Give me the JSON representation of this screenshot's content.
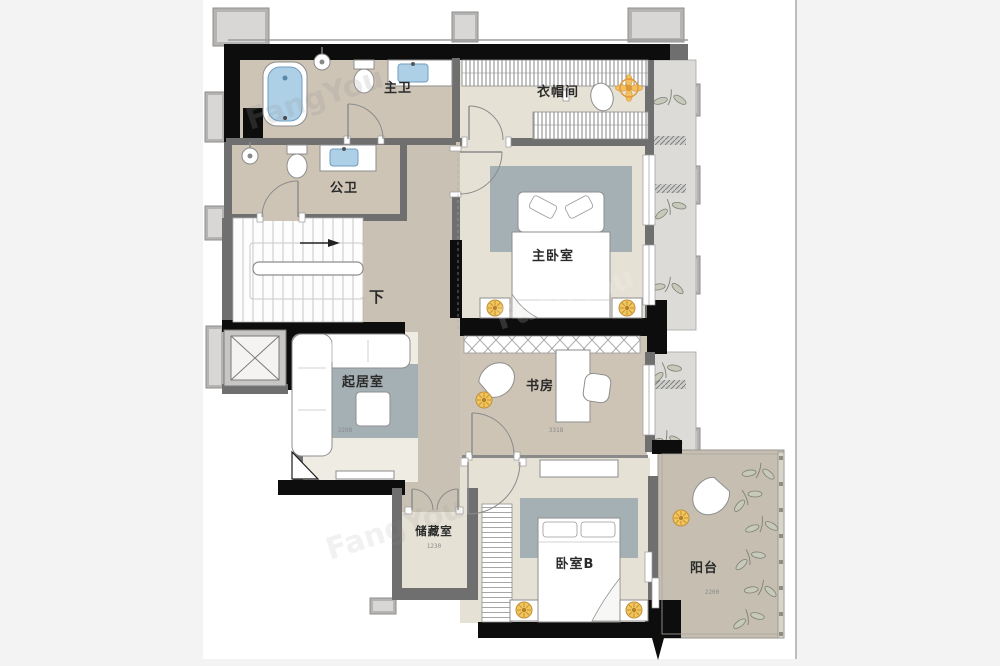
{
  "watermark": {
    "text": "FangYou"
  },
  "plan": {
    "labels": {
      "master_bath": "主卫",
      "closet": "衣帽间",
      "public_bath": "公卫",
      "master_bedroom": "主卧室",
      "stairs_down": "下",
      "living": "起居室",
      "study": "书房",
      "storage": "储藏室",
      "bedroom_b": "卧室B",
      "balcony": "阳台"
    },
    "dims": {
      "living": "2208",
      "study": "3318",
      "storage": "1230",
      "balcony": "2200"
    },
    "colors": {
      "wall_black": "#0d0d0d",
      "wall_gray": "#6f6f6f",
      "floor_bath": "#cdc4b5",
      "floor_room": "#e6e1d5",
      "floor_corridor": "#c9c2b4",
      "rug_blue_gray": "#a5b0b4",
      "fixture_blue": "#aed0e6",
      "light_orange": "#e0973b",
      "lamp_yellow": "#f2c65a"
    }
  }
}
